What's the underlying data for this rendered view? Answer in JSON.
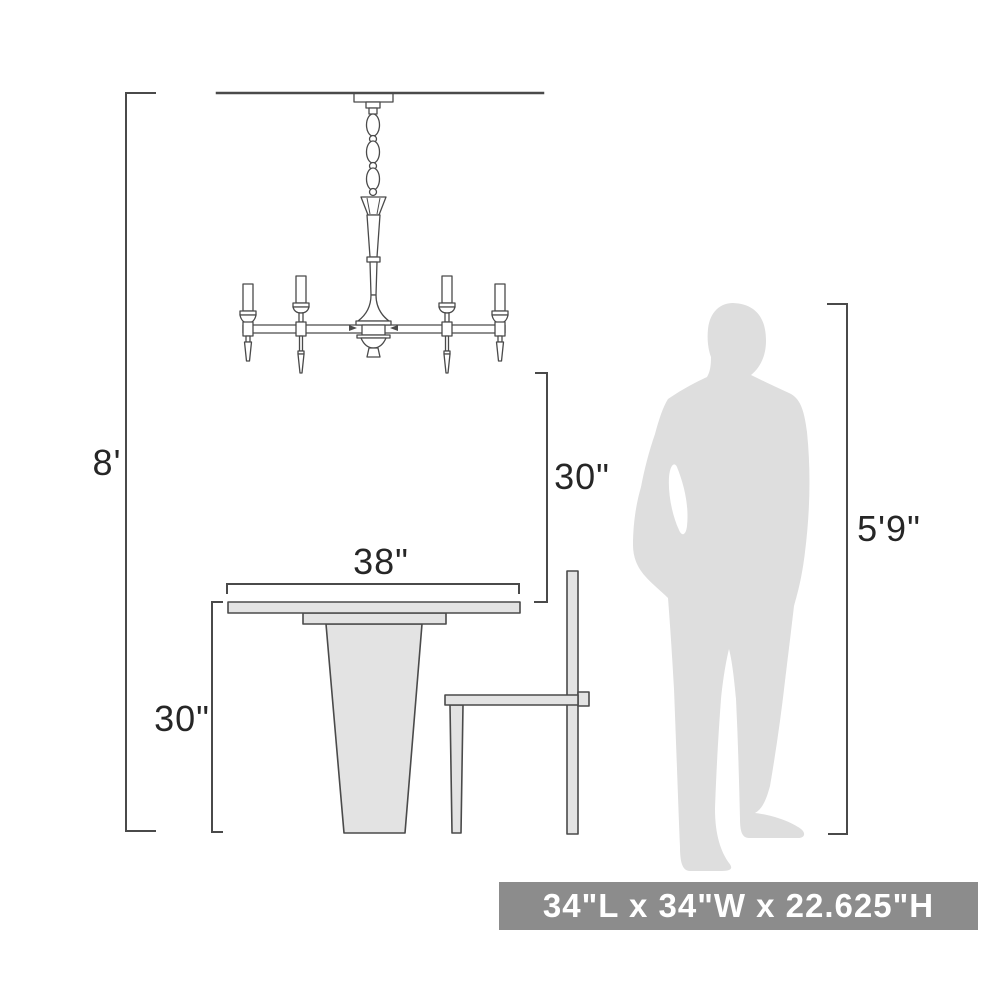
{
  "diagram": {
    "title": "chandelier-scale-dimension-diagram",
    "figures": [
      "chandelier",
      "dining-table",
      "dining-chair",
      "person-silhouette"
    ],
    "dimensions": {
      "ceiling_height": "8'",
      "hang_clearance": "30\"",
      "table_width": "38\"",
      "table_height": "30\"",
      "person_height": "5'9\""
    },
    "banner": {
      "text": "34\"L x 34\"W x 22.625\"H"
    },
    "colors": {
      "line": "#4a4a4a",
      "label_text": "#262626",
      "furniture_fill": "#e3e3e3",
      "person_fill": "#dedede",
      "banner_bg": "#8c8c8c",
      "banner_text": "#ffffff",
      "background": "#ffffff"
    }
  }
}
